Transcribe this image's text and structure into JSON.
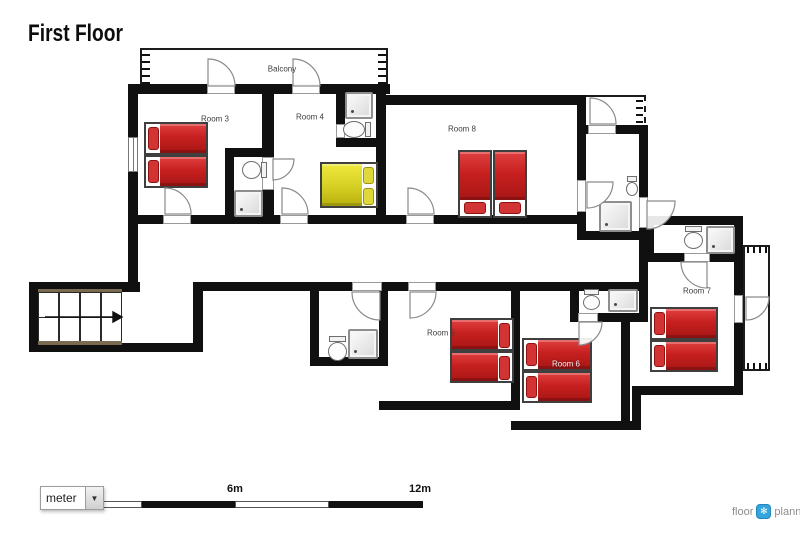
{
  "title": "First Floor",
  "plan": {
    "labels": {
      "balcony": "Balcony",
      "room3": "Room 3",
      "room4": "Room 4",
      "room5": "Room 5",
      "room6": "Room 6",
      "room7": "Room 7",
      "room8": "Room 8"
    },
    "colors": {
      "wall": "#101010",
      "bed_red": "#c6201f",
      "bed_yellow": "#d8d226"
    }
  },
  "scale_bar": {
    "unit_selected": "meter",
    "mid_label": "6m",
    "end_label": "12m"
  },
  "logo": {
    "part1": "floor",
    "part2": "planner"
  }
}
